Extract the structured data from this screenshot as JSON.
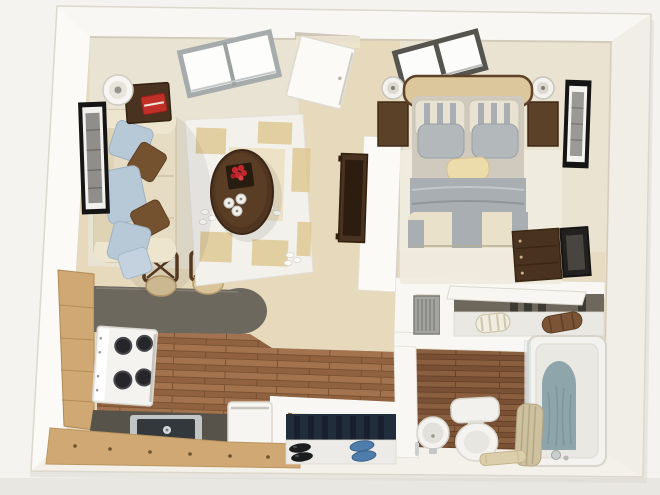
{
  "scene": {
    "type": "3d-floor-plan",
    "description": "Isometric 3D floor plan render of a studio apartment with living room, bedroom, kitchen, closet and bathroom",
    "rooms": [
      {
        "name": "living-room",
        "items": [
          "sofa",
          "blue-throw-pillows",
          "brown-throw-pillows",
          "floor-lamp",
          "end-table",
          "red-book",
          "area-rug",
          "oval-coffee-table",
          "flower-tray",
          "candles",
          "wall-art-frame",
          "skylight-window",
          "tv-console",
          "bar-stools"
        ]
      },
      {
        "name": "entry",
        "items": [
          "entry-door",
          "hall-floor",
          "shoe-closet",
          "black-shoes",
          "blue-shoes"
        ]
      },
      {
        "name": "bedroom",
        "items": [
          "double-bed",
          "headboard",
          "striped-pillows",
          "gray-pillows",
          "accent-pillow",
          "striped-duvet",
          "nightstand-left",
          "nightstand-right",
          "table-lamp-left",
          "table-lamp-right",
          "bedroom-window",
          "bedroom-rug",
          "dresser",
          "tv-frame",
          "wall-art-frame"
        ]
      },
      {
        "name": "kitchen",
        "items": [
          "breakfast-bar-counter",
          "l-counter",
          "wood-cabinets",
          "stove",
          "sink",
          "dishwasher",
          "wood-floor"
        ]
      },
      {
        "name": "closet",
        "items": [
          "sliding-door",
          "towel-roll",
          "blanket-roll",
          "hanging-clothes",
          "louvered-utility-door",
          "shelf"
        ]
      },
      {
        "name": "bathroom",
        "items": [
          "bathtub",
          "glass-panel",
          "bath-mat",
          "shower-curtain",
          "tub-faucet",
          "toilet",
          "pedestal-sink",
          "floor-towel",
          "wood-floor"
        ]
      }
    ]
  },
  "palette": {
    "bg": "#f4f3ef",
    "bgBottom": "#e9e7e2",
    "wall": "#f8f7f3",
    "wallLeft": "#fbfaf6",
    "wallRight": "#f1eee7",
    "wallBottom": "#f4f1ea",
    "wallEdge": "#ddd8cd",
    "floorHall": "#e6d9bc",
    "carpetLiving": "#e9e3d3",
    "carpetBedroom": "#eae3d1",
    "rugWhite": "#f3f1ec",
    "rugTan": "#dfc894",
    "woodLight": "#a2734e",
    "woodDark": "#8a5c3a",
    "woodLine": "#6f4a2c",
    "bathWoodLight": "#8a5f40",
    "bathWoodDark": "#744c30",
    "counter": "#6d685e",
    "counterDark": "#57534a",
    "cabinet": "#d0a873",
    "sofa": "#e6dcc4",
    "sofaTrim": "#d2c5a6",
    "pillowBlue": "#b7c8d6",
    "pillowBrown": "#74522f",
    "furnitureWood": "#4a3220",
    "tableTop": "#503621",
    "flowerRed": "#c4282e",
    "redBook": "#c03028",
    "headboard": "#dcc79c",
    "bedCream": "#e9e1ca",
    "bedGray": "#a9aeb3",
    "nightstand": "#5c4129",
    "navyCloset": "#222d3c",
    "shoeBlue": "#4f7dab",
    "tubMat": "#8ea6ab",
    "curtain": "#cdc1a0",
    "louver": "#a3a3a0",
    "frameBlack": "#151515",
    "fixtureWhite": "#f4f3ef"
  }
}
